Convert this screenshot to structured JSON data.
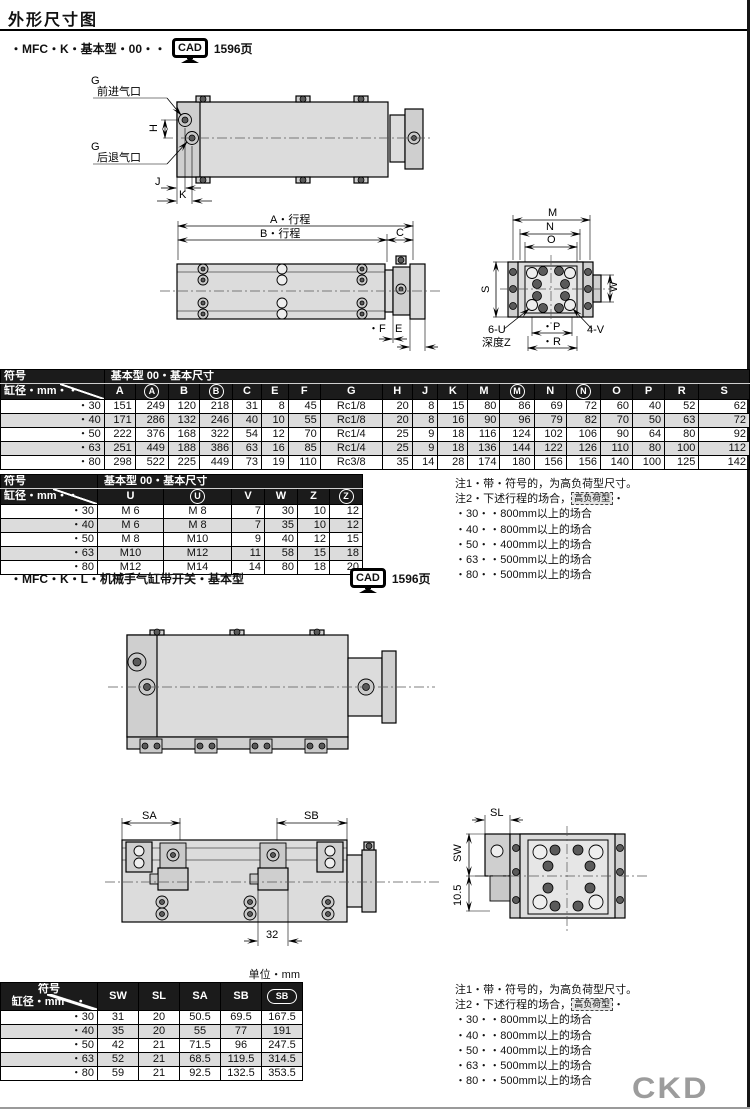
{
  "page": {
    "title": "外形尺寸图",
    "unit_label": "单位・mm",
    "brand": "CKD"
  },
  "cad": {
    "label": "CAD"
  },
  "sections": {
    "s1": {
      "header": "・MFC・K・基本型・00・・",
      "page_ref": "1596页"
    },
    "s2": {
      "header": "・MFC・K・L・机械手气缸带开关・基本型",
      "page_ref": "1596页"
    }
  },
  "drawing1": {
    "g_top": "G",
    "g_top_sub": "前进气口",
    "g_bot": "G",
    "g_bot_sub": "后退气口",
    "h": "H",
    "j": "J",
    "k": "K"
  },
  "drawing2": {
    "a": "A・行程",
    "b": "B・行程",
    "c": "C",
    "e": "E",
    "f": "・F"
  },
  "drawing3": {
    "m": "M",
    "n": "N",
    "o": "O",
    "s": "S",
    "w": "W",
    "p": "・P",
    "r": "・R",
    "u": "6-U",
    "depth": "深度Z",
    "v": "4-V"
  },
  "drawing5": {
    "sa": "SA",
    "sb": "SB",
    "dim32": "32"
  },
  "drawing6": {
    "sl": "SL",
    "sw": "SW",
    "d105": "10.5"
  },
  "table1": {
    "corner_top": "符号",
    "corner_bottom": "缸径・mm・・",
    "span_header": "基本型 00・基本尺寸",
    "columns": [
      {
        "label": "A"
      },
      {
        "label": "A",
        "circled": true
      },
      {
        "label": "B"
      },
      {
        "label": "B",
        "circled": true
      },
      {
        "label": "C"
      },
      {
        "label": "E"
      },
      {
        "label": "F"
      },
      {
        "label": "G"
      },
      {
        "label": "H"
      },
      {
        "label": "J"
      },
      {
        "label": "K"
      },
      {
        "label": "M"
      },
      {
        "label": "M",
        "circled": true
      },
      {
        "label": "N"
      },
      {
        "label": "N",
        "circled": true
      },
      {
        "label": "O"
      },
      {
        "label": "P"
      },
      {
        "label": "R"
      },
      {
        "label": "S"
      }
    ],
    "center_cols": [
      7
    ],
    "rows": [
      {
        "bore": "・30",
        "shaded": false,
        "values": [
          "151",
          "249",
          "120",
          "218",
          "31",
          "8",
          "45",
          "Rc1/8",
          "20",
          "8",
          "15",
          "80",
          "86",
          "69",
          "72",
          "60",
          "40",
          "52",
          "62"
        ]
      },
      {
        "bore": "・40",
        "shaded": true,
        "values": [
          "171",
          "286",
          "132",
          "246",
          "40",
          "10",
          "55",
          "Rc1/8",
          "20",
          "8",
          "16",
          "90",
          "96",
          "79",
          "82",
          "70",
          "50",
          "63",
          "72"
        ]
      },
      {
        "bore": "・50",
        "shaded": false,
        "values": [
          "222",
          "376",
          "168",
          "322",
          "54",
          "12",
          "70",
          "Rc1/4",
          "25",
          "9",
          "18",
          "116",
          "124",
          "102",
          "106",
          "90",
          "64",
          "80",
          "92"
        ]
      },
      {
        "bore": "・63",
        "shaded": true,
        "values": [
          "251",
          "449",
          "188",
          "386",
          "63",
          "16",
          "85",
          "Rc1/4",
          "25",
          "9",
          "18",
          "136",
          "144",
          "122",
          "126",
          "110",
          "80",
          "100",
          "112"
        ]
      },
      {
        "bore": "・80",
        "shaded": false,
        "values": [
          "298",
          "522",
          "225",
          "449",
          "73",
          "19",
          "110",
          "Rc3/8",
          "35",
          "14",
          "28",
          "174",
          "180",
          "156",
          "156",
          "140",
          "100",
          "125",
          "142"
        ]
      }
    ]
  },
  "table2": {
    "corner_top": "符号",
    "corner_bottom": "缸径・mm・・",
    "span_header": "基本型 00・基本尺寸",
    "columns": [
      {
        "label": "U"
      },
      {
        "label": "U",
        "circled": true
      },
      {
        "label": "V"
      },
      {
        "label": "W"
      },
      {
        "label": "Z"
      },
      {
        "label": "Z",
        "circled": true
      }
    ],
    "center_cols": [
      0,
      1
    ],
    "rows": [
      {
        "bore": "・30",
        "shaded": false,
        "values": [
          "M 6",
          "M 8",
          "7",
          "30",
          "10",
          "12"
        ]
      },
      {
        "bore": "・40",
        "shaded": true,
        "values": [
          "M 6",
          "M 8",
          "7",
          "35",
          "10",
          "12"
        ]
      },
      {
        "bore": "・50",
        "shaded": false,
        "values": [
          "M 8",
          "M10",
          "9",
          "40",
          "12",
          "15"
        ]
      },
      {
        "bore": "・63",
        "shaded": true,
        "values": [
          "M10",
          "M12",
          "11",
          "58",
          "15",
          "18"
        ]
      },
      {
        "bore": "・80",
        "shaded": false,
        "values": [
          "M12",
          "M14",
          "14",
          "80",
          "18",
          "20"
        ]
      }
    ]
  },
  "table3": {
    "corner_top": "符号",
    "corner_bottom": "缸径・mm・・",
    "columns": [
      {
        "label": "SW"
      },
      {
        "label": "SL"
      },
      {
        "label": "SA"
      },
      {
        "label": "SB"
      },
      {
        "label": "SB",
        "circled": true,
        "oval": true
      }
    ],
    "rows": [
      {
        "bore": "・30",
        "shaded": false,
        "values": [
          "31",
          "20",
          "50.5",
          "69.5",
          "167.5"
        ]
      },
      {
        "bore": "・40",
        "shaded": true,
        "values": [
          "35",
          "20",
          "55",
          "77",
          "191"
        ]
      },
      {
        "bore": "・50",
        "shaded": false,
        "values": [
          "42",
          "21",
          "71.5",
          "96",
          "247.5"
        ]
      },
      {
        "bore": "・63",
        "shaded": true,
        "values": [
          "52",
          "21",
          "68.5",
          "119.5",
          "314.5"
        ]
      },
      {
        "bore": "・80",
        "shaded": false,
        "values": [
          "59",
          "21",
          "92.5",
          "132.5",
          "353.5"
        ]
      }
    ]
  },
  "notes": {
    "line1": "注1・带・符号的，为高负荷型尺寸。",
    "line2_pre": "注2・下述行程的场合，",
    "line2_box": "高负荷型",
    "line2_post": "・",
    "items": [
      "・30・・800mm以上的场合",
      "・40・・800mm以上的场合",
      "・50・・400mm以上的场合",
      "・63・・500mm以上的场合",
      "・80・・500mm以上的场合"
    ]
  }
}
